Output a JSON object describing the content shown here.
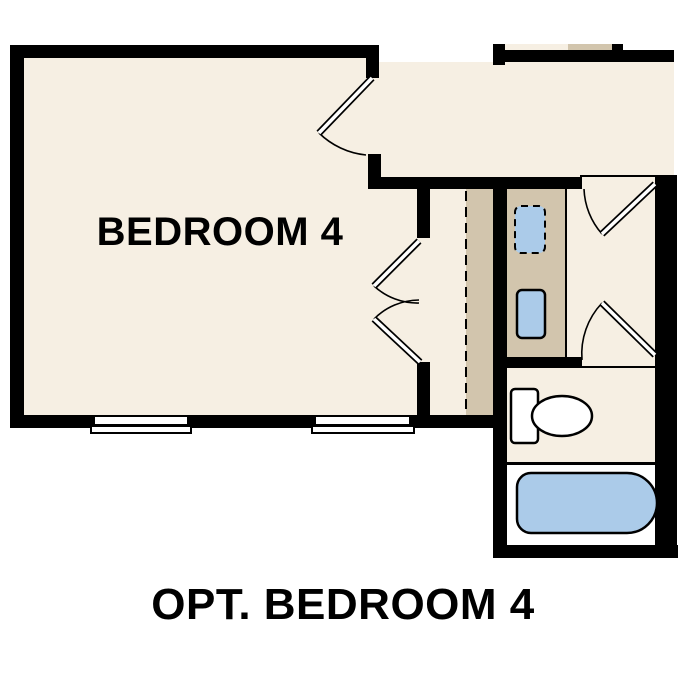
{
  "title": "OPT. BEDROOM 4",
  "rooms": {
    "bedroom": {
      "label": "BEDROOM 4"
    },
    "hallway": {
      "label": ""
    },
    "closet": {
      "features": [
        "hanging-rod",
        "shelf"
      ]
    },
    "bathroom": {
      "fixtures": [
        "vanity-sink",
        "optional-vanity-sink",
        "toilet",
        "bathtub"
      ]
    }
  },
  "colors": {
    "wall": "#000000",
    "floor": "#f6efe3",
    "cabinet": "#d2c5ad",
    "fixture-blue": "#abcbe9",
    "fixture-white": "#ffffff",
    "paper": "#ffffff"
  }
}
